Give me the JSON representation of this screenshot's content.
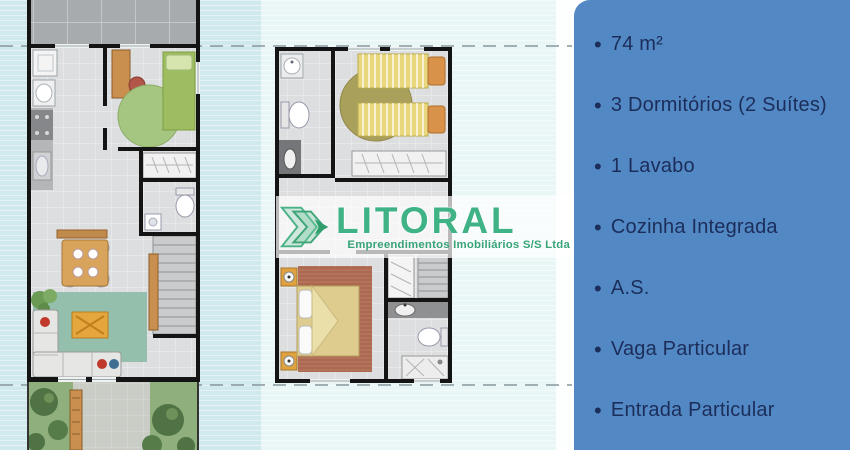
{
  "palette": {
    "bg-cyan": "#cfe9ec",
    "bg-column": "#e9f6f6",
    "panel-bg": "#5289c5",
    "panel-text": "#1c2d5a",
    "brand-green": "#3fb286",
    "tagline-green": "#37a377",
    "band-white": "rgba(255,255,255,0.70)"
  },
  "watermark": {
    "brand": "LITORAL",
    "tagline": "Empreendimentos Imobiliários S/S Ltda"
  },
  "panel": {
    "bullet": "•",
    "features": [
      "74 m²",
      "3 Dormitórios (2 Suítes)",
      "1 Lavabo",
      "Cozinha Integrada",
      "A.S.",
      "Vaga Particular",
      "Entrada Particular"
    ]
  }
}
